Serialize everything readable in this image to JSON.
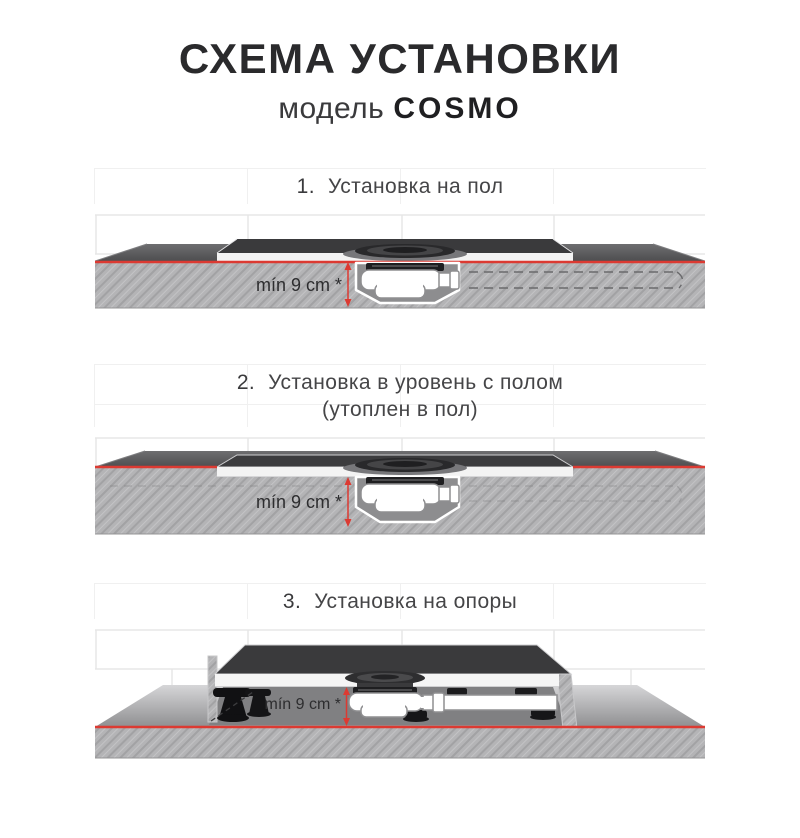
{
  "header": {
    "title": "СХЕМА УСТАНОВКИ",
    "model_label": "модель",
    "model_name": "COSMO"
  },
  "sections": [
    {
      "number": "1.",
      "title": "Установка на пол",
      "dimension_label": "mín 9 cm *"
    },
    {
      "number": "2.",
      "title": "Установка в уровень с полом",
      "subtitle": "(утоплен в пол)",
      "dimension_label": "mín 9 cm *"
    },
    {
      "number": "3.",
      "title": "Установка на опоры",
      "dimension_label": "mín 9 cm *"
    }
  ],
  "colors": {
    "accent_red": "#dc3a32",
    "tray_top_dark": "#3a3a3c",
    "floor_top_dark": "#58585a",
    "slab_gray": "#b4b4b6",
    "recess_gray": "#8d8d8f",
    "siphon_white": "#ffffff",
    "support_black": "#141416",
    "tile_line": "#e7e7e7"
  }
}
